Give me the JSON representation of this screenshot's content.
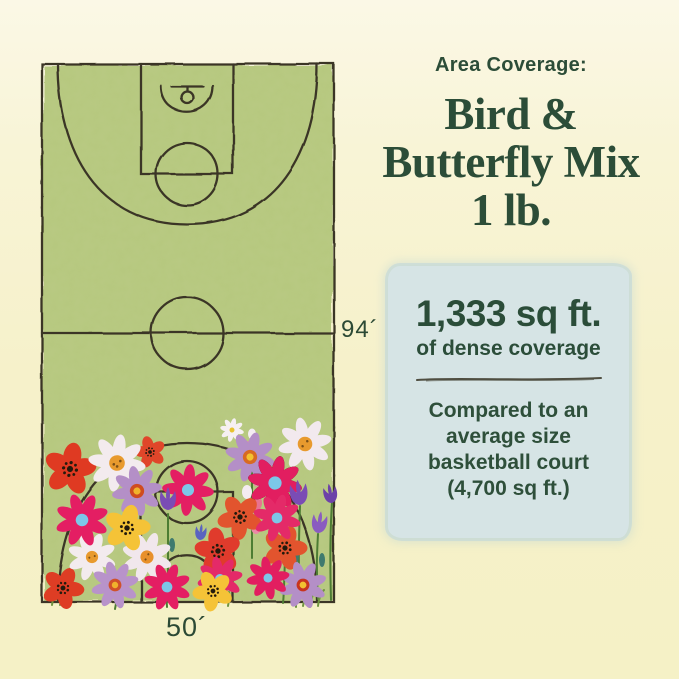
{
  "page": {
    "background": "#f6f1ca",
    "text_green": "#2c4d38"
  },
  "header": {
    "eyebrow": "Area Coverage:",
    "title_lines": [
      "Bird &",
      "Butterfly Mix",
      "1 lb."
    ]
  },
  "coverage_card": {
    "bg_color": "#d6e4e5",
    "headline": "1,333 sq ft.",
    "subline": "of dense coverage",
    "comparison_lines": [
      "Compared to an",
      "average size",
      "basketball court",
      "(4,700 sq ft.)"
    ]
  },
  "court": {
    "length_label": "94´",
    "width_label": "50´",
    "court_green": "#b6c87e",
    "line_color": "#3a3626",
    "illustration": "hand-drawn basketball court covered with wildflowers at one end"
  }
}
